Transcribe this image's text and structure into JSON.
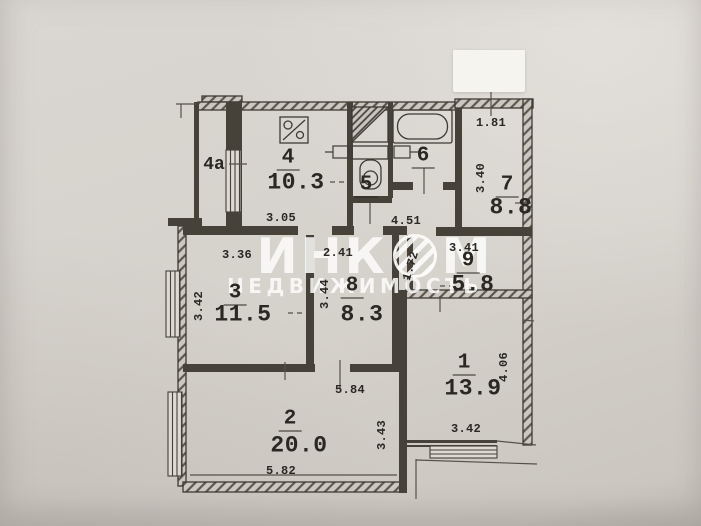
{
  "watermark": {
    "brand_left": "ИНК",
    "brand_right": "М",
    "subtitle": "НЕДВИЖИМОСТЬ"
  },
  "rooms": {
    "r4a": {
      "number": "4а"
    },
    "r4": {
      "number": "4",
      "area": "10.3"
    },
    "r5": {
      "number": "5"
    },
    "r6": {
      "number": "6"
    },
    "r7": {
      "number": "7",
      "area": "8.8"
    },
    "r9": {
      "number": "9",
      "area": "5.8"
    },
    "r3": {
      "number": "3",
      "area": "11.5"
    },
    "r8": {
      "number": "8",
      "area": "8.3"
    },
    "r1": {
      "number": "1",
      "area": "13.9"
    },
    "r2": {
      "number": "2",
      "area": "20.0"
    }
  },
  "dims": {
    "w181": "1.81",
    "v340": "3.40",
    "w305": "3.05",
    "w451": "4.51",
    "w336": "3.36",
    "w241": "2.41",
    "w341": "3.41",
    "v172": "1.72",
    "v342": "3.42",
    "v344": "3.44",
    "v406": "4.06",
    "w342": "3.42",
    "w584": "5.84",
    "v343": "3.43",
    "w582": "5.82"
  }
}
